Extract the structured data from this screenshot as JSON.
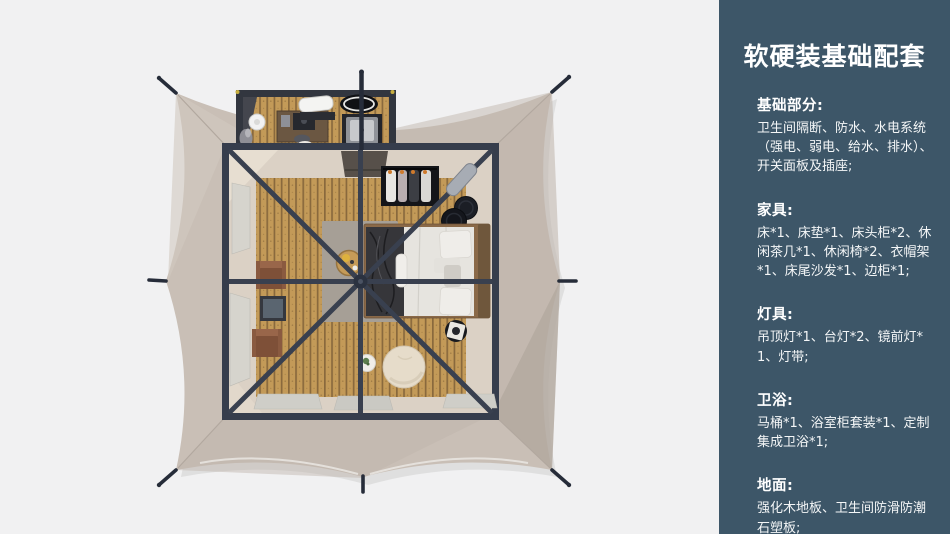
{
  "sidebar": {
    "title": "软硬装基础配套",
    "sections": [
      {
        "heading": "基础部分:",
        "body": "卫生间隔断、防水、水电系统（强电、弱电、给水、排水）、开关面板及插座;"
      },
      {
        "heading": "家具:",
        "body": "床*1、床垫*1、床头柜*2、休闲茶几*1、休闲椅*2、衣帽架*1、床尾沙发*1、边柜*1;"
      },
      {
        "heading": "灯具:",
        "body": "吊顶灯*1、台灯*2、镜前灯*1、灯带;"
      },
      {
        "heading": "卫浴:",
        "body": "马桶*1、浴室柜套装*1、定制集成卫浴*1;"
      },
      {
        "heading": "地面:",
        "body": "强化木地板、卫生间防滑防潮石塑板;"
      }
    ]
  },
  "scene": {
    "colors": {
      "background": "#f1f1f2",
      "sidebar_bg": "#3d5668",
      "text": "#ffffff",
      "tent_canvas": "#c9bfb6",
      "canvas_shade": "#ada39a",
      "frame": "#363d4c",
      "wood_floor": "#c39a58",
      "floor_border": "#dbd1c5",
      "rug": "#a69f96",
      "bed_linen": "#e6e4df",
      "leather_chair": "#7e5038",
      "pouf": "#e6dcca",
      "hardware_dot": "#c7ae3e"
    }
  }
}
